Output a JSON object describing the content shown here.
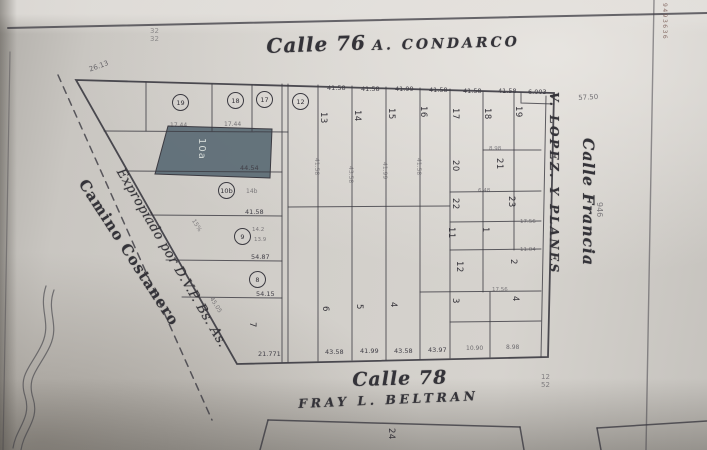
{
  "colors": {
    "ink": "#3b3a41",
    "paper": "#cdcac5",
    "shaded_lot_fill": "#5a6a74"
  },
  "streets": {
    "top": {
      "calle": "Calle 76",
      "name": "A. CONDARCO"
    },
    "bottom": {
      "calle": "Calle 78",
      "name": "FRAY L. BELTRAN"
    },
    "left": {
      "name": "Camino Costanero"
    },
    "right": {
      "inner": "V. LOPEZ. Y PLANES",
      "outer": "Calle Francia"
    }
  },
  "notes": {
    "expropriation": "Expropiado por D.V.P. Bs. As."
  },
  "shaded_lot": {
    "label": "10a"
  },
  "edge_stamp": "9493636",
  "circled_lots": [
    {
      "t": "19",
      "x": 172,
      "y": 94
    },
    {
      "t": "18",
      "x": 227,
      "y": 92
    },
    {
      "t": "17",
      "x": 256,
      "y": 91
    },
    {
      "t": "12",
      "x": 292,
      "y": 93
    },
    {
      "t": "10b",
      "x": 218,
      "y": 182
    },
    {
      "t": "9",
      "x": 234,
      "y": 228
    },
    {
      "t": "8",
      "x": 249,
      "y": 271
    }
  ],
  "lot_numbers": [
    {
      "t": "13",
      "x": 328,
      "y": 112,
      "r": 90
    },
    {
      "t": "14",
      "x": 362,
      "y": 110,
      "r": 90
    },
    {
      "t": "15",
      "x": 396,
      "y": 108,
      "r": 90
    },
    {
      "t": "16",
      "x": 428,
      "y": 106,
      "r": 90
    },
    {
      "t": "6",
      "x": 330,
      "y": 306,
      "r": 90
    },
    {
      "t": "5",
      "x": 364,
      "y": 304,
      "r": 90
    },
    {
      "t": "4",
      "x": 398,
      "y": 302,
      "r": 90
    },
    {
      "t": "7",
      "x": 257,
      "y": 322,
      "r": 90
    },
    {
      "t": "17",
      "x": 460,
      "y": 108,
      "r": 90
    },
    {
      "t": "18",
      "x": 492,
      "y": 108,
      "r": 90
    },
    {
      "t": "19",
      "x": 523,
      "y": 106,
      "r": 90
    },
    {
      "t": "20",
      "x": 460,
      "y": 160,
      "r": 90
    },
    {
      "t": "21",
      "x": 504,
      "y": 158,
      "r": 90
    },
    {
      "t": "22",
      "x": 460,
      "y": 198,
      "r": 90
    },
    {
      "t": "23",
      "x": 516,
      "y": 196,
      "r": 90
    },
    {
      "t": "11",
      "x": 456,
      "y": 227,
      "r": 90
    },
    {
      "t": "1",
      "x": 490,
      "y": 227,
      "r": 90
    },
    {
      "t": "12",
      "x": 464,
      "y": 261,
      "r": 90
    },
    {
      "t": "2",
      "x": 518,
      "y": 259,
      "r": 90
    },
    {
      "t": "3",
      "x": 460,
      "y": 298,
      "r": 90
    },
    {
      "t": "4",
      "x": 520,
      "y": 296,
      "r": 90
    },
    {
      "t": "24",
      "x": 396,
      "y": 428,
      "r": 90
    }
  ],
  "dimensions": [
    {
      "t": "41.58",
      "x": 327,
      "y": 84,
      "s": 6.5
    },
    {
      "t": "41.58",
      "x": 361,
      "y": 85,
      "s": 6.5
    },
    {
      "t": "41.99",
      "x": 395,
      "y": 85,
      "s": 6.5
    },
    {
      "t": "41.58",
      "x": 429,
      "y": 86,
      "s": 6.5
    },
    {
      "t": "41.58",
      "x": 463,
      "y": 87,
      "s": 6.5
    },
    {
      "t": "41.58",
      "x": 498,
      "y": 87,
      "s": 6.5
    },
    {
      "t": "6.003",
      "x": 528,
      "y": 88,
      "s": 6.5
    },
    {
      "t": "57.50",
      "x": 578,
      "y": 94,
      "s": 7,
      "r": -3,
      "o": 0.7
    },
    {
      "t": "26.13",
      "x": 88,
      "y": 66,
      "s": 7,
      "r": -20,
      "o": 0.7
    },
    {
      "t": "17.44",
      "x": 170,
      "y": 122,
      "s": 6,
      "o": 0.65
    },
    {
      "t": "17.44",
      "x": 224,
      "y": 121,
      "s": 6,
      "o": 0.65
    },
    {
      "t": "44.54",
      "x": 240,
      "y": 164,
      "s": 6.5
    },
    {
      "t": "41.58",
      "x": 245,
      "y": 208,
      "s": 6.5
    },
    {
      "t": "54.87",
      "x": 251,
      "y": 253,
      "s": 6.5
    },
    {
      "t": "54.15",
      "x": 256,
      "y": 290,
      "s": 6.5
    },
    {
      "t": "21.771",
      "x": 258,
      "y": 350,
      "s": 6.5
    },
    {
      "t": "14b",
      "x": 246,
      "y": 188,
      "s": 6,
      "o": 0.6
    },
    {
      "t": "14.2",
      "x": 252,
      "y": 227,
      "s": 5.5,
      "o": 0.6
    },
    {
      "t": "13.9",
      "x": 254,
      "y": 237,
      "s": 5.5,
      "o": 0.6
    },
    {
      "t": "15%",
      "x": 196,
      "y": 218,
      "s": 6,
      "r": 58,
      "o": 0.55
    },
    {
      "t": "45.05",
      "x": 214,
      "y": 296,
      "s": 6,
      "r": 58,
      "o": 0.6
    },
    {
      "t": "43.58",
      "x": 325,
      "y": 348,
      "s": 6.5
    },
    {
      "t": "41.99",
      "x": 360,
      "y": 347,
      "s": 6.5
    },
    {
      "t": "43.58",
      "x": 394,
      "y": 347,
      "s": 6.5
    },
    {
      "t": "43.97",
      "x": 428,
      "y": 346,
      "s": 6.5
    },
    {
      "t": "10.90",
      "x": 466,
      "y": 345,
      "s": 6,
      "o": 0.7
    },
    {
      "t": "8.98",
      "x": 506,
      "y": 344,
      "s": 6,
      "o": 0.7
    },
    {
      "t": "8.98",
      "x": 489,
      "y": 146,
      "s": 5.5,
      "o": 0.6
    },
    {
      "t": "6.48",
      "x": 478,
      "y": 188,
      "s": 5.5,
      "o": 0.6
    },
    {
      "t": "17.56",
      "x": 520,
      "y": 219,
      "s": 5.5,
      "o": 0.6
    },
    {
      "t": "11.04",
      "x": 520,
      "y": 247,
      "s": 5.5,
      "o": 0.6
    },
    {
      "t": "17.56",
      "x": 492,
      "y": 287,
      "s": 5.5,
      "o": 0.6
    },
    {
      "t": "41.58",
      "x": 320,
      "y": 158,
      "s": 6,
      "r": 90,
      "o": 0.5
    },
    {
      "t": "43.58",
      "x": 354,
      "y": 166,
      "s": 6,
      "r": 90,
      "o": 0.5
    },
    {
      "t": "41.99",
      "x": 388,
      "y": 162,
      "s": 6,
      "r": 90,
      "o": 0.5
    },
    {
      "t": "41.58",
      "x": 422,
      "y": 158,
      "s": 6,
      "r": 90,
      "o": 0.5
    },
    {
      "t": "946",
      "x": 604,
      "y": 202,
      "s": 8,
      "r": 90,
      "o": 0.6
    }
  ],
  "stacked_marks": [
    {
      "lines": [
        "32",
        "32"
      ],
      "x": 150,
      "y": 28,
      "s": 7,
      "o": 0.5
    },
    {
      "lines": [
        "12",
        "52"
      ],
      "x": 541,
      "y": 374,
      "s": 7,
      "o": 0.6
    }
  ]
}
